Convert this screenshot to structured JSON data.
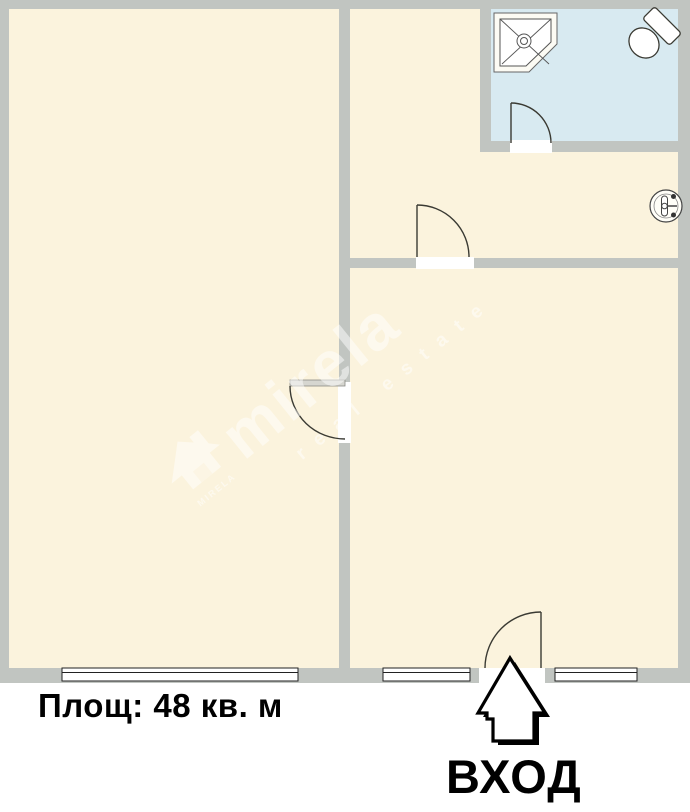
{
  "floor_plan": {
    "area_label": "Площ: 48 кв. м",
    "entrance_label": "ВХОД",
    "watermark": {
      "brand": "mirela",
      "logo_text": "mirela",
      "tagline": "real estate"
    },
    "colors": {
      "wall": "#c1c5c1",
      "floor": "#fbf3dd",
      "bathroom_floor": "#d8eaf1",
      "opening_white": "#ffffff",
      "line": "#3a3a33",
      "label_text": "#000000"
    },
    "fixtures": [
      "corner-shower",
      "toilet",
      "wall-sink"
    ],
    "windows_count": "3",
    "doors_count": "4"
  }
}
